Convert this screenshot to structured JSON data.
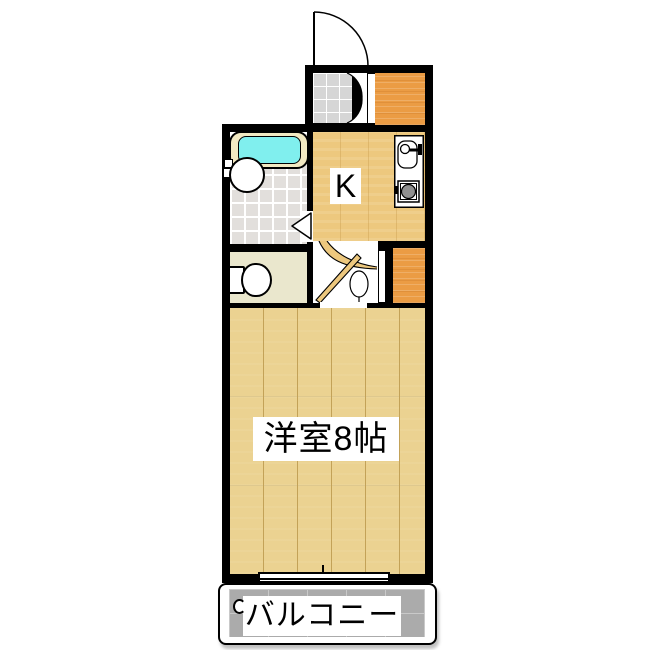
{
  "labels": {
    "kitchen": "K",
    "western_room": "洋室8帖",
    "balcony": "バルコニー"
  },
  "colors": {
    "wall": "#000000",
    "text": "#000000",
    "label_bg": "#ffffff",
    "kitchen_floor": "#edc87e",
    "room_floor": "#ebd291",
    "plank_line": "#c3a258",
    "closet": "#eb9c44",
    "genkan_tile": "#d6d6d6",
    "bath_tile": "#e2dfdc",
    "grout": "#ffffff",
    "water": "#80efee",
    "tub_rim": "#f2e9c2",
    "toilet_floor": "#eae7cd",
    "balcony_floor": "#ababab",
    "balcony_grid": "#c9c9c9",
    "stove": "#909090"
  }
}
